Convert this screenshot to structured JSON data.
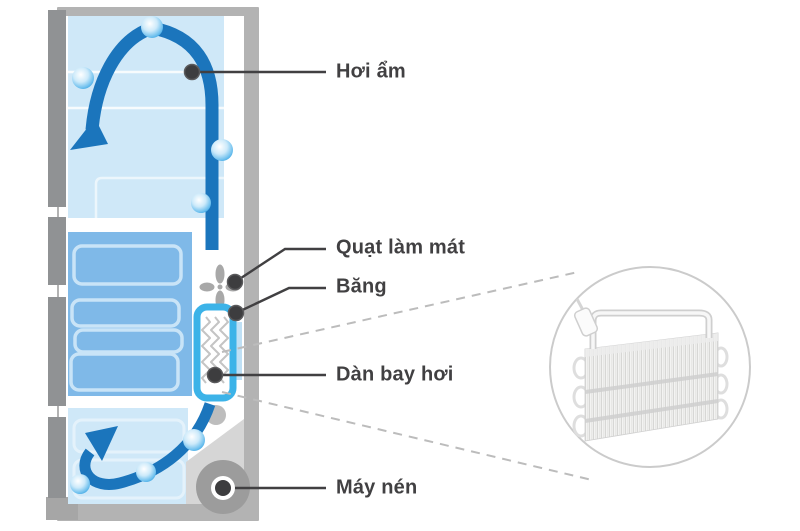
{
  "labels": {
    "moisture": "Hơi ẩm",
    "cooling_fan": "Quạt làm mát",
    "ice": "Băng",
    "evaporator": "Dàn bay hơi",
    "compressor": "Máy nén"
  },
  "icons": {
    "fan": "cooling-fan-icon",
    "droplet": "moisture-droplet-icon",
    "airflow": "airflow-arrow-icon",
    "magnifier": "zoom-inset-circle"
  },
  "colors": {
    "arrow_blue": "#1b75bc",
    "interior_light_blue": "#cfe8f8",
    "drawer_blue": "#7fb9e8",
    "drawer_outline": "#c9e4f7",
    "evaporator_border": "#3cb3e8",
    "cabinet_gray": "#b3b3b3",
    "door_gray": "#909294",
    "compressor_gray": "#9c9c9c",
    "bay_gray": "#d6d6d6",
    "fan_gray": "#a8a8a8",
    "label_text": "#414042",
    "dashed_line": "#bcbcbc",
    "inset_ring": "#cbcbcb"
  }
}
